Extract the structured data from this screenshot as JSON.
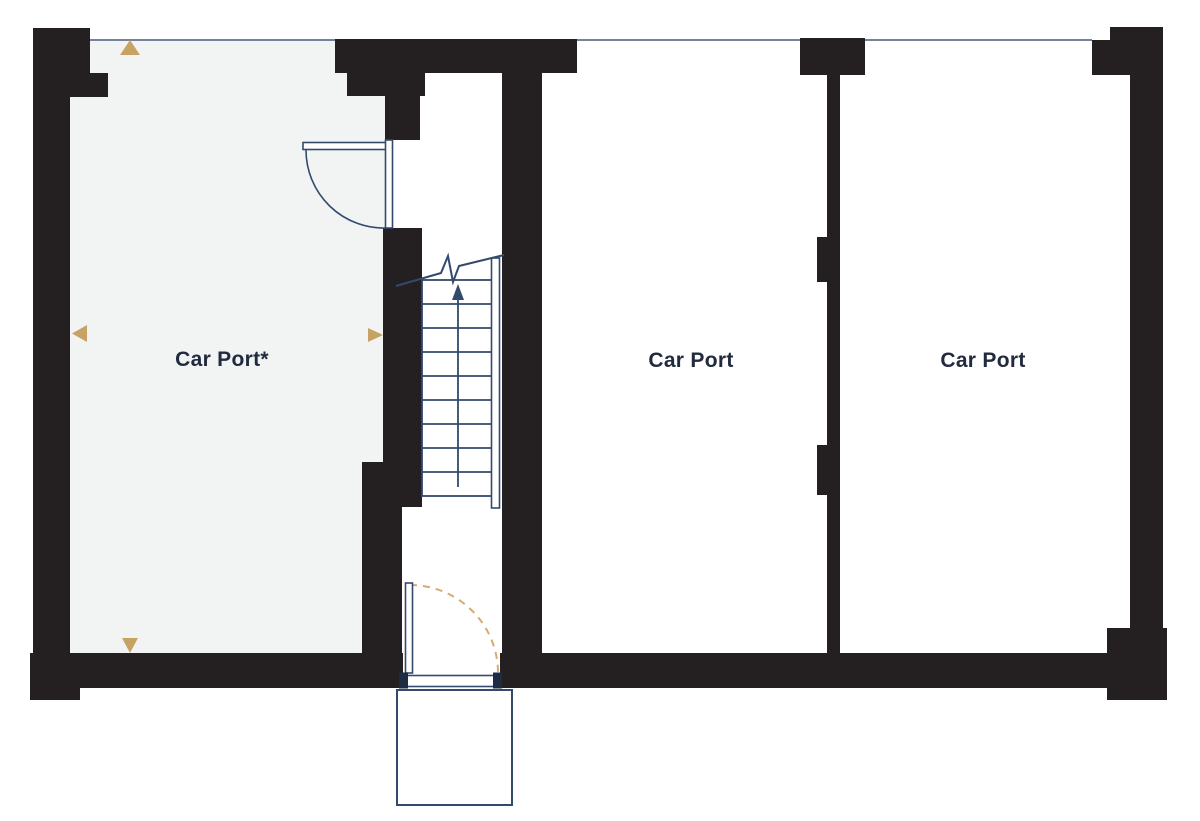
{
  "plan": {
    "type": "floor-plan",
    "level": "carport-level"
  },
  "rooms": [
    {
      "id": "car-port-left",
      "label": "Car Port*"
    },
    {
      "id": "car-port-middle",
      "label": "Car Port"
    },
    {
      "id": "car-port-right",
      "label": "Car Port"
    }
  ],
  "markers": {
    "dimension_arrows": [
      "up-triangle",
      "down-triangle",
      "left-triangle",
      "right-triangle"
    ],
    "stairs_direction": "up"
  },
  "colors": {
    "wall": "#241f21",
    "room_fill": "#f2f4f4",
    "line_navy": "#33496d",
    "thin_edge_line": "#74839c",
    "accent_tan": "#c7a265",
    "label_text": "#212b3d"
  }
}
